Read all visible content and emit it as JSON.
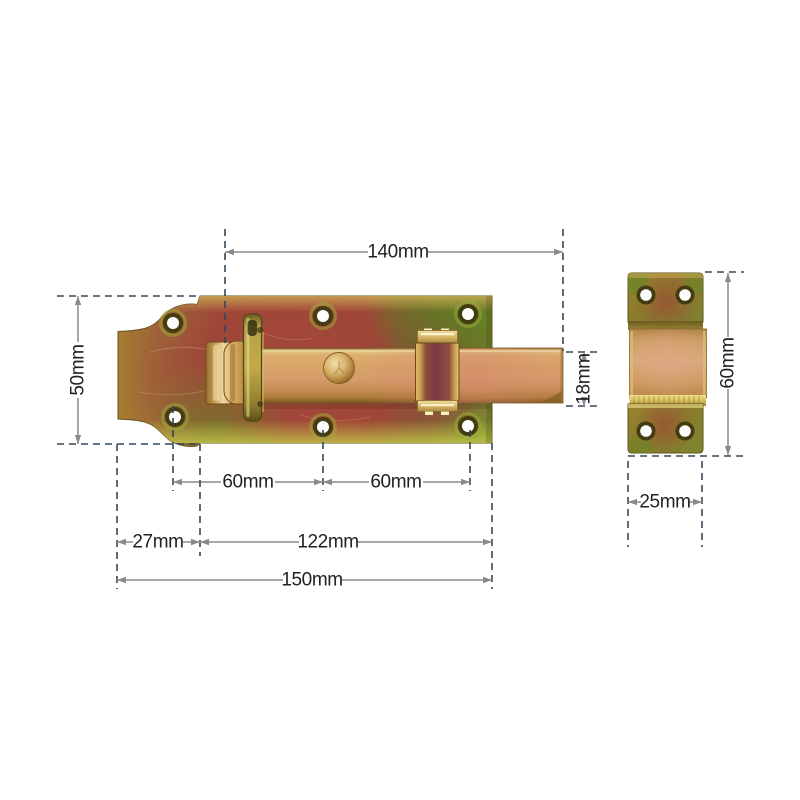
{
  "diagram": {
    "bolt_view": {
      "labels": {
        "bar_length": "140mm",
        "plate_height": "50mm",
        "bar_height": "18mm",
        "hole_spacing_left": "60mm",
        "hole_spacing_right": "60mm",
        "head_section_width": "27mm",
        "plate_section_width": "122mm",
        "total_width": "150mm"
      }
    },
    "keeper_view": {
      "labels": {
        "height": "60mm",
        "width": "25mm"
      }
    },
    "style": {
      "extension_line_color": "#33475a",
      "dimension_line_color": "#8a8a8a",
      "label_color": "#222222",
      "finish_gold": "#c49a4e",
      "finish_red": "#a04438",
      "finish_green": "#6b7d2a",
      "background": "#ffffff"
    }
  }
}
